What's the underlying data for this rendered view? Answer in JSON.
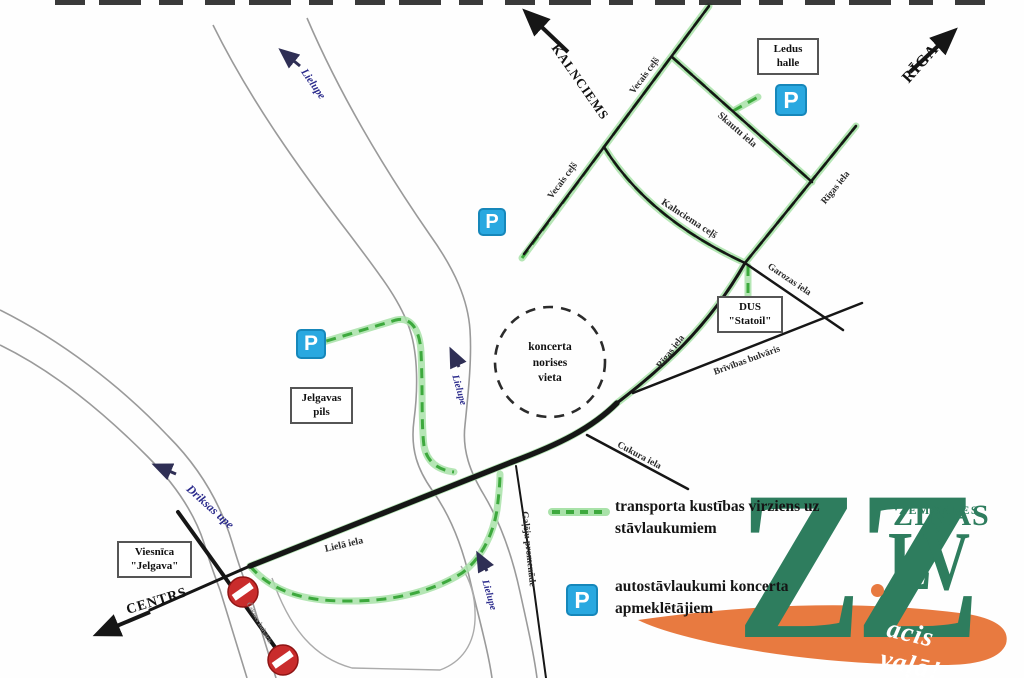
{
  "map": {
    "destination_labels": [
      {
        "text": "KALNCIEMS"
      },
      {
        "text": "RĪGA"
      },
      {
        "text": "CENTRS"
      }
    ],
    "place_boxes": [
      {
        "line1": "Ledus",
        "line2": "halle"
      },
      {
        "line1": "DUS",
        "line2": "\"Statoil\""
      },
      {
        "line1": "Jelgavas",
        "line2": "pils"
      },
      {
        "line1": "Viesnīca",
        "line2": "\"Jelgava\""
      }
    ],
    "venue_circle": {
      "line1": "koncerta",
      "line2": "norises",
      "line3": "vieta"
    },
    "street_labels": [
      {
        "text": "Vecais ceļš"
      },
      {
        "text": "Vecais ceļš"
      },
      {
        "text": "Skautu iela"
      },
      {
        "text": "Rīgas iela"
      },
      {
        "text": "Kalnciema ceļš"
      },
      {
        "text": "Garozas iela"
      },
      {
        "text": "Rīgas iela"
      },
      {
        "text": "Brīvības bulvāris"
      },
      {
        "text": "Cukura iela"
      },
      {
        "text": "Lielā iela"
      },
      {
        "text": "Gaļēju promenāde"
      },
      {
        "text": "Čakstes bulvāris"
      }
    ],
    "river_labels": [
      {
        "text": "Lielupe"
      },
      {
        "text": "Lielupe"
      },
      {
        "text": "Lielupe"
      },
      {
        "text": "Driksas upe"
      }
    ],
    "parking_symbol": "P"
  },
  "legend": {
    "route_label": "transporta kustības virziens uz stāvlaukumiem",
    "parking_label": "autostāvlaukumi koncerta apmeklētājiem",
    "parking_symbol": "P"
  },
  "logo": {
    "zz": "ZZ",
    "lv": "LV",
    "zemgales": "ZEMGALES",
    "zinas": "ZIŅAS",
    "tagline": "acis vaļā!"
  },
  "colors": {
    "route_green": "#3da93d",
    "route_glow": "#a9e2a9",
    "road_black": "#161616",
    "river_gray": "#9a9a9a",
    "parking_blue": "#29a8e0",
    "no_entry_red": "#c92c2c",
    "river_label_blue": "#2b2b8c",
    "logo_green": "#2e7d5e",
    "logo_orange": "#e87a40"
  }
}
